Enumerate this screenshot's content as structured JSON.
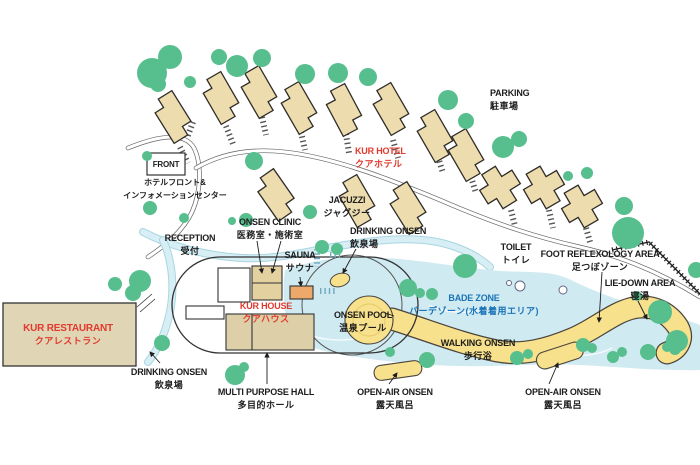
{
  "map": {
    "description": "Kur resort facility map with hotel cottages, spa house and bade zone"
  },
  "colors": {
    "tree_green": "#57bf8d",
    "water_blue": "#cfeaf1",
    "stream_edge": "#a8d6e2",
    "pool_yellow": "#f8e18c",
    "building_tan": "#ecdcae",
    "restaurant_tan": "#e0d5b4",
    "sauna_orange": "#eda96a",
    "outline_dark": "#2f2c28",
    "road_gray": "#666666",
    "accent_red": "#e2392e",
    "accent_blue": "#1b74b8",
    "text_black": "#1c1c1c"
  },
  "labels": [
    {
      "id": "parking",
      "en": "PARKING",
      "jp": "駐車場",
      "x": 490,
      "y": 87,
      "align": "left"
    },
    {
      "id": "kur-hotel",
      "en": "KUR HOTEL",
      "jp": "クアホテル",
      "x": 355,
      "y": 145,
      "align": "left",
      "color": "red"
    },
    {
      "id": "front",
      "en": "FRONT",
      "x": 166,
      "y": 158,
      "align": "center",
      "size": "sm"
    },
    {
      "id": "front-info",
      "jp": "ホテルフロント&",
      "jp2": "インフォメーションセンター",
      "x": 175,
      "y": 176,
      "align": "center",
      "size": "sm"
    },
    {
      "id": "onsen-clinic",
      "en": "ONSEN CLINIC",
      "jp": "医務室・施術室",
      "x": 270,
      "y": 216,
      "align": "center"
    },
    {
      "id": "jacuzzi",
      "en": "JACUZZI",
      "jp": "ジャグジー",
      "x": 347,
      "y": 194,
      "align": "center"
    },
    {
      "id": "drinking-onsen-top",
      "en": "DRINKING ONSEN",
      "jp": "飲泉場",
      "x": 350,
      "y": 225,
      "align": "left"
    },
    {
      "id": "reception",
      "en": "RECEPTION",
      "jp": "受付",
      "x": 190,
      "y": 232,
      "align": "center"
    },
    {
      "id": "sauna",
      "en": "SAUNA",
      "jp": "サウナ",
      "x": 300,
      "y": 249,
      "align": "center"
    },
    {
      "id": "toilet",
      "en": "TOILET",
      "jp": "トイレ",
      "x": 516,
      "y": 241,
      "align": "center"
    },
    {
      "id": "foot-reflexology",
      "en": "FOOT REFLEXOLOGY AREA",
      "jp": "足つぼゾーン",
      "x": 600,
      "y": 248,
      "align": "center"
    },
    {
      "id": "lie-down",
      "en": "LIE-DOWN AREA",
      "jp": "寝湯",
      "x": 640,
      "y": 277,
      "align": "center"
    },
    {
      "id": "kur-house",
      "en": "KUR HOUSE",
      "jp": "クアハウス",
      "x": 266,
      "y": 300,
      "align": "center",
      "color": "red"
    },
    {
      "id": "bade-zone",
      "en": "BADE ZONE",
      "jp": "バーデゾーン(水着着用エリア)",
      "x": 474,
      "y": 292,
      "align": "center",
      "color": "blue"
    },
    {
      "id": "onsen-pool",
      "en": "ONSEN POOL",
      "jp": "温泉プール",
      "x": 363,
      "y": 309,
      "align": "center"
    },
    {
      "id": "walking-onsen",
      "en": "WALKING ONSEN",
      "jp": "歩行浴",
      "x": 478,
      "y": 337,
      "align": "center"
    },
    {
      "id": "kur-restaurant",
      "en": "KUR RESTAURANT",
      "jp": "クアレストラン",
      "x": 68,
      "y": 322,
      "align": "center",
      "color": "red",
      "size": "lg"
    },
    {
      "id": "drinking-onsen-bottom",
      "en": "DRINKING ONSEN",
      "jp": "飲泉場",
      "x": 169,
      "y": 366,
      "align": "center"
    },
    {
      "id": "multi-purpose-hall",
      "en": "MULTI PURPOSE HALL",
      "jp": "多目的ホール",
      "x": 266,
      "y": 386,
      "align": "center"
    },
    {
      "id": "open-air-onsen-left",
      "en": "OPEN-AIR ONSEN",
      "jp": "露天風呂",
      "x": 395,
      "y": 386,
      "align": "center"
    },
    {
      "id": "open-air-onsen-right",
      "en": "OPEN-AIR ONSEN",
      "jp": "露天風呂",
      "x": 563,
      "y": 386,
      "align": "center"
    }
  ]
}
